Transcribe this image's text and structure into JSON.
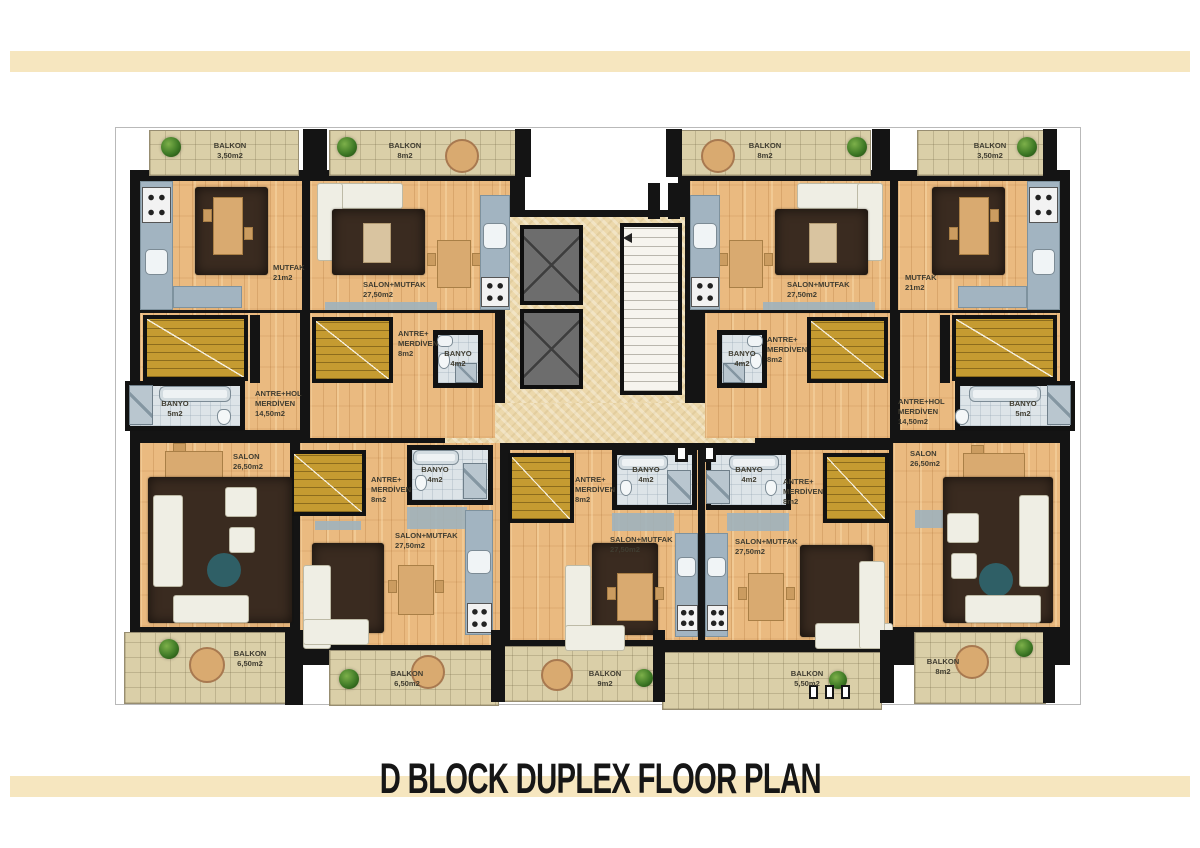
{
  "title": "D BLOCK DUPLEX FLOOR PLAN",
  "colors": {
    "accent_bar": "#f6e6bf",
    "wall": "#141414",
    "wood": "#eaba80",
    "stone": "#ecd8ab",
    "tile": "#dacfa8",
    "stair": "#c59b31",
    "bath": "#dde4e8",
    "counter": "#a2b4c1",
    "rug": "#3a2b20",
    "lift": "#6d6d6d",
    "sofa": "#efeee4",
    "table_wood": "#d9aa70",
    "teal": "#2f5f66"
  },
  "rooms": {
    "tl_balkon_a": {
      "label": "BALKON",
      "area": "3,50m2"
    },
    "tl_balkon_b": {
      "label": "BALKON",
      "area": "8m2"
    },
    "tl_mutfak": {
      "label": "MUTFAK",
      "area": "21m2"
    },
    "tl_salon": {
      "label": "SALON+MUTFAK",
      "area": "27,50m2"
    },
    "tl_antre": {
      "label": "ANTRE+\nMERDİVEN",
      "area": "8m2"
    },
    "tl_banyo4": {
      "label": "BANYO",
      "area": "4m2"
    },
    "tl_hall": {
      "label": "ANTRE+HOL\nMERDİVEN",
      "area": "14,50m2"
    },
    "tl_banyo5": {
      "label": "BANYO",
      "area": "5m2"
    },
    "tr_salon": {
      "label": "SALON+MUTFAK",
      "area": "27,50m2"
    },
    "tr_mutfak": {
      "label": "MUTFAK",
      "area": "21m2"
    },
    "tr_balkon_b": {
      "label": "BALKON",
      "area": "8m2"
    },
    "tr_balkon_a": {
      "label": "BALKON",
      "area": "3,50m2"
    },
    "tr_antre": {
      "label": "ANTRE+\nMERDİVEN",
      "area": "8m2"
    },
    "tr_banyo4": {
      "label": "BANYO",
      "area": "4m2"
    },
    "tr_hall": {
      "label": "ANTRE+HOL\nMERDİVEN",
      "area": "14,50m2"
    },
    "tr_banyo5": {
      "label": "BANYO",
      "area": "5m2"
    },
    "bl_salon": {
      "label": "SALON",
      "area": "26,50m2"
    },
    "bl_balkon": {
      "label": "BALKON",
      "area": "6,50m2"
    },
    "bl_antre": {
      "label": "ANTRE+\nMERDİVEN",
      "area": "8m2"
    },
    "bl_banyo4": {
      "label": "BANYO",
      "area": "4m2"
    },
    "bl_salonmutfak": {
      "label": "SALON+MUTFAK",
      "area": "27,50m2"
    },
    "bl_balkon2": {
      "label": "BALKON",
      "area": "6,50m2"
    },
    "bc_antre_l": {
      "label": "ANTRE+\nMERDİVEN",
      "area": "8m2"
    },
    "bc_banyo4_l": {
      "label": "BANYO",
      "area": "4m2"
    },
    "bc_salonmutfak_l": {
      "label": "SALON+MUTFAK",
      "area": "27,50m2"
    },
    "b_balkon9": {
      "label": "BALKON",
      "area": "9m2"
    },
    "bc_banyo4_r": {
      "label": "BANYO",
      "area": "4m2"
    },
    "bc_antre_r": {
      "label": "ANTRE+\nMERDİVEN",
      "area": "8m2"
    },
    "bc_salonmutfak_r": {
      "label": "SALON+MUTFAK",
      "area": "27,50m2"
    },
    "b_balkon55": {
      "label": "BALKON",
      "area": "5,50m2"
    },
    "br_salon": {
      "label": "SALON",
      "area": "26,50m2"
    },
    "br_balkon8": {
      "label": "BALKON",
      "area": "8m2"
    }
  }
}
